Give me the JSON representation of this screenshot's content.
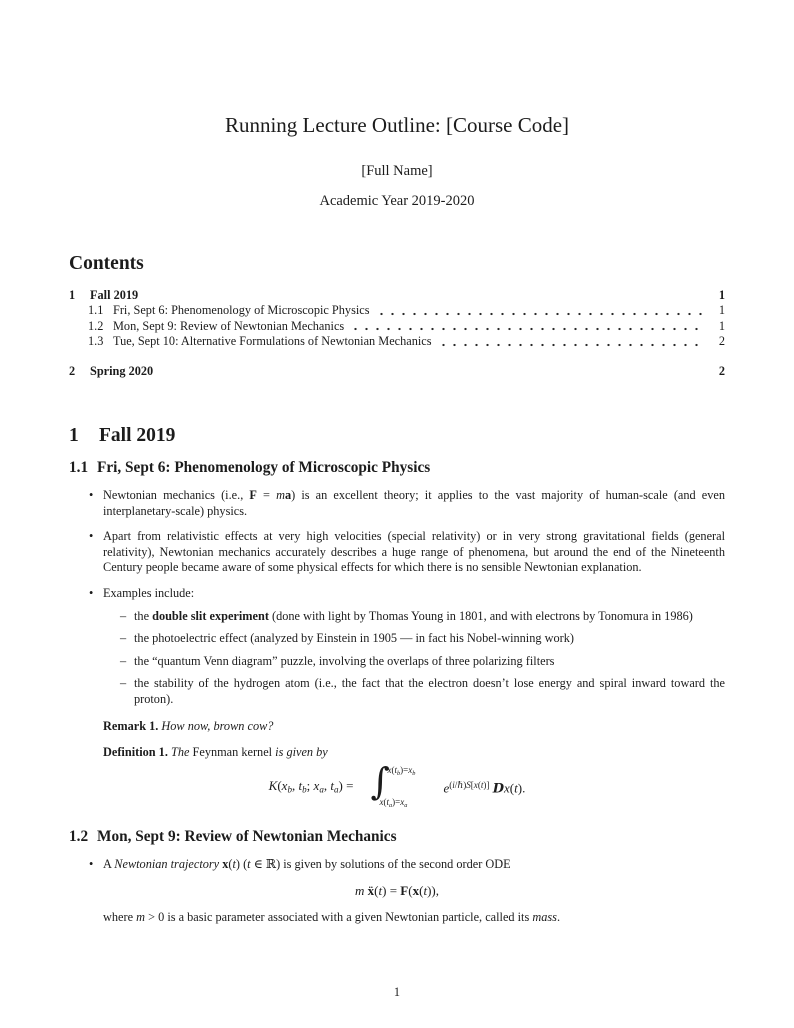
{
  "page": {
    "background": "#ffffff",
    "text_color": "#1c1c1c",
    "page_number": "1"
  },
  "header": {
    "title": "Running Lecture Outline: [Course Code]",
    "author": "[Full Name]",
    "date": "Academic Year 2019-2020"
  },
  "contents": {
    "heading": "Contents",
    "entries": [
      {
        "num": "1",
        "label": "Fall 2019",
        "page": "1"
      },
      {
        "num": "1.1",
        "label": "Fri, Sept 6: Phenomenology of Microscopic Physics",
        "page": "1"
      },
      {
        "num": "1.2",
        "label": "Mon, Sept 9: Review of Newtonian Mechanics",
        "page": "1"
      },
      {
        "num": "1.3",
        "label": "Tue, Sept 10: Alternative Formulations of Newtonian Mechanics",
        "page": "2"
      },
      {
        "num": "2",
        "label": "Spring 2020",
        "page": "2"
      }
    ]
  },
  "section1": {
    "num": "1",
    "title": "Fall 2019"
  },
  "sub11": {
    "num": "1.1",
    "title": "Fri, Sept 6: Phenomenology of Microscopic Physics",
    "bullet_marker": "•",
    "dash_marker": "–",
    "bullet1": [
      {
        "t": "Newtonian mechanics (i.e., ",
        "c": ""
      },
      {
        "t": "F",
        "c": "bf"
      },
      {
        "t": " = ",
        "c": ""
      },
      {
        "t": "m",
        "c": "it"
      },
      {
        "t": "a",
        "c": "bf"
      },
      {
        "t": ") is an excellent theory; it applies to the vast majority of human-scale (and even interplanetary-scale) physics.",
        "c": ""
      }
    ],
    "bullet2": [
      {
        "t": "Apart from relativistic effects at very high velocities (special relativity) or in very strong gravitational fields (general relativity), Newtonian mechanics accurately describes a huge range of phenomena, but around the end of the Nineteenth Century people became aware of some physical effects for which there is no sensible Newtonian explanation.",
        "c": ""
      }
    ],
    "bullet3": [
      {
        "t": "Examples include:",
        "c": ""
      }
    ],
    "example1": [
      {
        "t": "the ",
        "c": ""
      },
      {
        "t": "double slit experiment",
        "c": "bf"
      },
      {
        "t": " (done with light by Thomas Young in 1801, and with electrons by Tonomura in 1986)",
        "c": ""
      }
    ],
    "example2": [
      {
        "t": "the photoelectric effect (analyzed by Einstein in 1905 — in fact his Nobel-winning work)",
        "c": ""
      }
    ],
    "example3": [
      {
        "t": "the “quantum Venn diagram” puzzle, involving the overlaps of three polarizing filters",
        "c": ""
      }
    ],
    "example4": [
      {
        "t": "the stability of the hydrogen atom (i.e., the fact that the electron doesn’t lose energy and spiral inward toward the proton).",
        "c": ""
      }
    ],
    "remark": {
      "label": "Remark 1.",
      "body": [
        {
          "t": " How now, brown cow?",
          "c": "it"
        }
      ]
    },
    "definition": {
      "label": "Definition 1.",
      "body": [
        {
          "t": " The ",
          "c": "it"
        },
        {
          "t": "Feynman kernel",
          "c": ""
        },
        {
          "t": " is given by",
          "c": "it"
        }
      ]
    },
    "formula": {
      "lhs": [
        {
          "t": "K",
          "c": "it"
        },
        {
          "t": "(",
          "c": ""
        },
        {
          "t": "x",
          "c": "it"
        },
        {
          "t": "b",
          "c": "it sub"
        },
        {
          "t": ", ",
          "c": ""
        },
        {
          "t": "t",
          "c": "it"
        },
        {
          "t": "b",
          "c": "it sub"
        },
        {
          "t": "; ",
          "c": ""
        },
        {
          "t": "x",
          "c": "it"
        },
        {
          "t": "a",
          "c": "it sub"
        },
        {
          "t": ", ",
          "c": ""
        },
        {
          "t": "t",
          "c": "it"
        },
        {
          "t": "a",
          "c": "it sub"
        },
        {
          "t": ") = ",
          "c": ""
        }
      ],
      "integral_sign": "∫",
      "upper_limit": [
        {
          "t": "x",
          "c": "it"
        },
        {
          "t": "(",
          "c": ""
        },
        {
          "t": "t",
          "c": "it"
        },
        {
          "t": "b",
          "c": "it sub"
        },
        {
          "t": ")=",
          "c": ""
        },
        {
          "t": "x",
          "c": "it"
        },
        {
          "t": "b",
          "c": "it sub"
        }
      ],
      "lower_limit": [
        {
          "t": "x",
          "c": "it"
        },
        {
          "t": "(",
          "c": ""
        },
        {
          "t": "t",
          "c": "it"
        },
        {
          "t": "a",
          "c": "it sub"
        },
        {
          "t": ")=",
          "c": ""
        },
        {
          "t": "x",
          "c": "it"
        },
        {
          "t": "a",
          "c": "it sub"
        }
      ],
      "rhs": [
        {
          "t": "e",
          "c": "it"
        },
        {
          "t": "(",
          "c": "sup"
        },
        {
          "t": "i",
          "c": "sup it"
        },
        {
          "t": "/",
          "c": "sup"
        },
        {
          "t": "ℏ",
          "c": "sup it"
        },
        {
          "t": ")",
          "c": "sup"
        },
        {
          "t": "S",
          "c": "sup it"
        },
        {
          "t": "[",
          "c": "sup"
        },
        {
          "t": "x",
          "c": "sup it"
        },
        {
          "t": "(",
          "c": "sup"
        },
        {
          "t": "t",
          "c": "sup it"
        },
        {
          "t": ")]",
          "c": "sup"
        },
        {
          "t": " ",
          "c": ""
        },
        {
          "t": "D",
          "c": "scr"
        },
        {
          "t": "x",
          "c": "it"
        },
        {
          "t": "(",
          "c": ""
        },
        {
          "t": "t",
          "c": "it"
        },
        {
          "t": ").",
          "c": ""
        }
      ]
    }
  },
  "sub12": {
    "num": "1.2",
    "title": "Mon, Sept 9: Review of Newtonian Mechanics",
    "bullet_marker": "•",
    "bullet1": [
      {
        "t": "A ",
        "c": ""
      },
      {
        "t": "Newtonian trajectory",
        "c": "it"
      },
      {
        "t": " ",
        "c": ""
      },
      {
        "t": "x",
        "c": "bf"
      },
      {
        "t": "(",
        "c": ""
      },
      {
        "t": "t",
        "c": "it"
      },
      {
        "t": ") (",
        "c": ""
      },
      {
        "t": "t",
        "c": "it"
      },
      {
        "t": " ∈ ℝ) is given by solutions of the second order ODE",
        "c": ""
      }
    ],
    "equation": [
      {
        "t": "m",
        "c": "it"
      },
      {
        "t": " ",
        "c": ""
      },
      {
        "t": "ẍ",
        "c": "bf"
      },
      {
        "t": "(",
        "c": ""
      },
      {
        "t": "t",
        "c": "it"
      },
      {
        "t": ") = ",
        "c": ""
      },
      {
        "t": "F",
        "c": "bf"
      },
      {
        "t": "(",
        "c": ""
      },
      {
        "t": "x",
        "c": "bf"
      },
      {
        "t": "(",
        "c": ""
      },
      {
        "t": "t",
        "c": "it"
      },
      {
        "t": ")),",
        "c": ""
      }
    ],
    "closing": [
      {
        "t": "where ",
        "c": ""
      },
      {
        "t": "m",
        "c": "it"
      },
      {
        "t": " > 0 is a basic parameter associated with a given Newtonian particle, called its ",
        "c": ""
      },
      {
        "t": "mass",
        "c": "it"
      },
      {
        "t": ".",
        "c": ""
      }
    ]
  }
}
